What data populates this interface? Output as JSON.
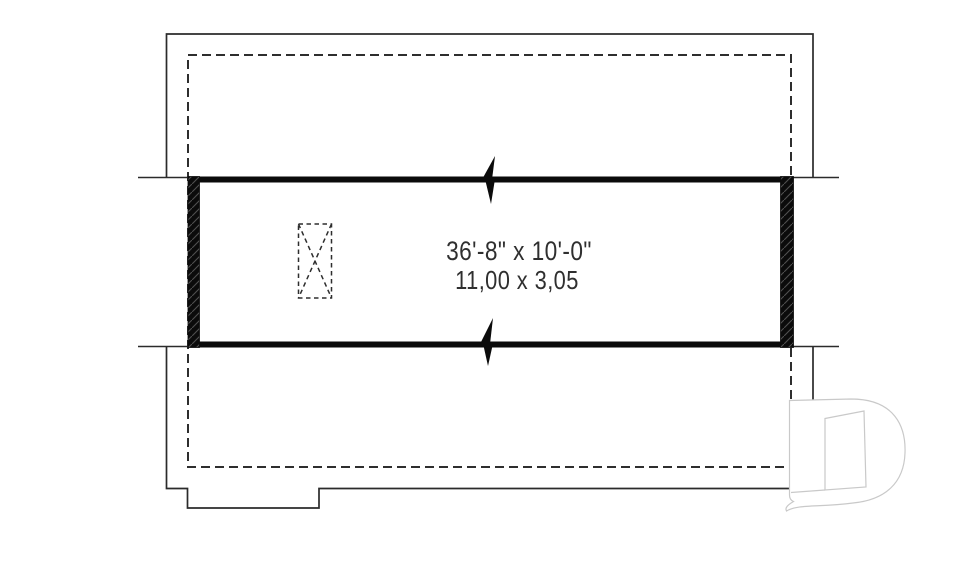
{
  "plan": {
    "dimensions": {
      "imperial": "36'-8\" x 10'-0\"",
      "metric": "11,00 x 3,05"
    },
    "palette": {
      "line": "#2b2b2b",
      "dashed_line": "#2e2e2e",
      "wall_fill": "#0b0b0b",
      "hatch_line": "#4f4f4f",
      "logo_outline": "#c9c9c9",
      "text": "#2f2f2f",
      "background": "#ffffff"
    }
  }
}
